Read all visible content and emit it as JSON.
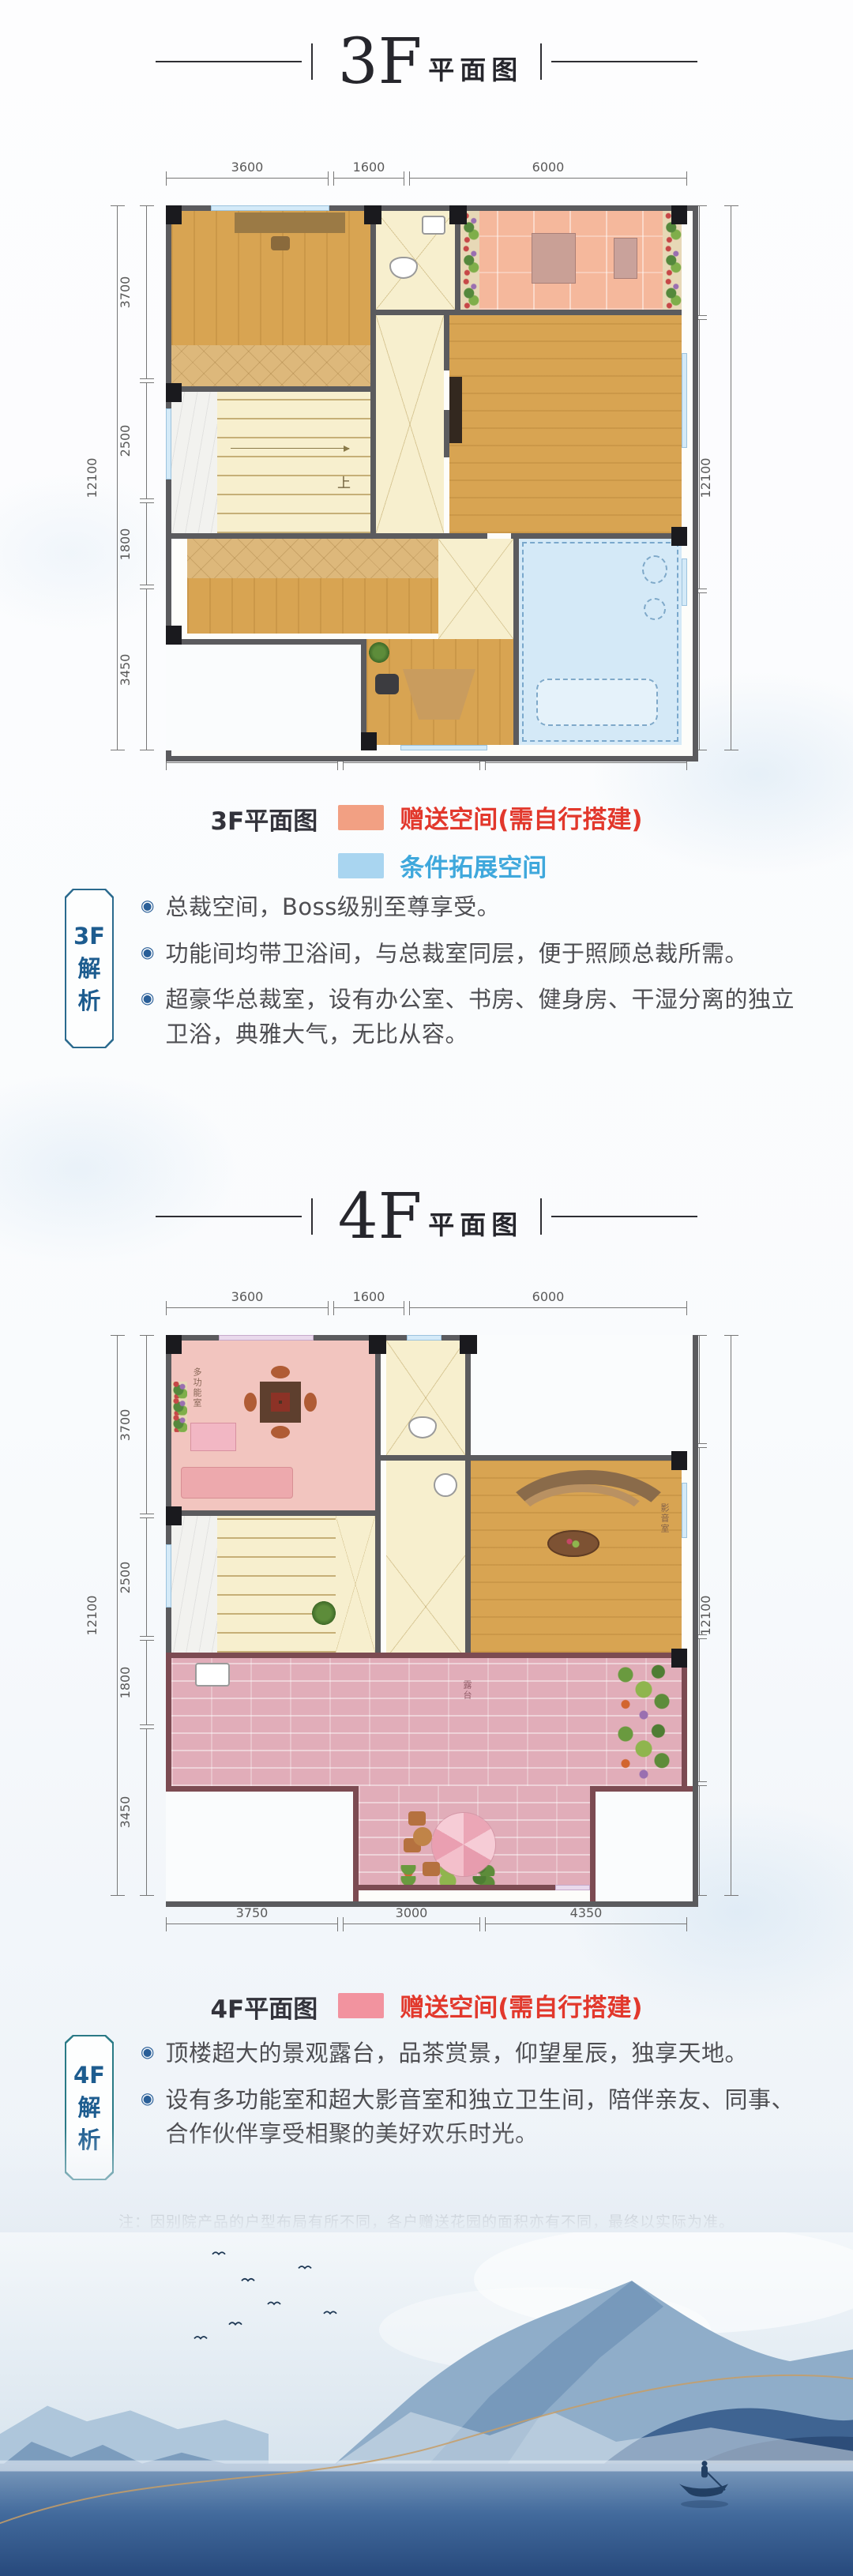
{
  "floor3": {
    "title": {
      "big": "3F",
      "small": "平面图"
    },
    "dims": {
      "top": [
        "3600",
        "1600",
        "6000"
      ],
      "bottom": [
        "3750",
        "3000",
        "4350"
      ],
      "left": [
        "3700",
        "2500",
        "1800",
        "3450"
      ],
      "right": [
        "2350",
        "5800",
        "3450"
      ],
      "total_left": "12100",
      "total_right": "12100"
    },
    "plan_labels": {
      "stair_up": "上"
    },
    "legend": {
      "name": "3F平面图",
      "items": [
        {
          "text": "赠送空间(需自行搭建)",
          "swatch": "#F2A083",
          "text_color": "#E2382C"
        },
        {
          "text": "条件拓展空间",
          "swatch": "#A9D5F0",
          "text_color": "#3FA8DC"
        }
      ]
    },
    "analysis": {
      "tag": [
        "3F",
        "解",
        "析"
      ],
      "bullets": [
        "总裁空间，Boss级别至尊享受。",
        "功能间均带卫浴间，与总裁室同层，便于照顾总裁所需。",
        "超豪华总裁室，设有办公室、书房、健身房、干湿分离的独立卫浴，典雅大气，无比从容。"
      ]
    }
  },
  "floor4": {
    "title": {
      "big": "4F",
      "small": "平面图"
    },
    "dims": {
      "top": [
        "3600",
        "1600",
        "6000"
      ],
      "bottom": [
        "3750",
        "3000",
        "4350"
      ],
      "left": [
        "3700",
        "2500",
        "1800",
        "3450"
      ],
      "right": [
        "2350",
        "4050",
        "3100",
        "2400"
      ],
      "total_left": "12100",
      "total_right": "12100"
    },
    "plan_labels": {
      "room_multi": "多功能室",
      "room_media": "影音室",
      "terrace": "露台"
    },
    "legend": {
      "name": "4F平面图",
      "items": [
        {
          "text": "赠送空间(需自行搭建)",
          "swatch": "#F2939F",
          "text_color": "#E2382C"
        }
      ]
    },
    "analysis": {
      "tag": [
        "4F",
        "解",
        "析"
      ],
      "bullets": [
        "顶楼超大的景观露台，品茶赏景，仰望星辰，独享天地。",
        "设有多功能室和超大影音室和独立卫生间，陪伴亲友、同事、合作伙伴享受相聚的美好欢乐时光。"
      ]
    }
  },
  "note": "注：因别院产品的户型布局有所不同，各户赠送花园的面积亦有不同，最终以实际为准。",
  "ui": {
    "bullet_glyph": "◉"
  }
}
